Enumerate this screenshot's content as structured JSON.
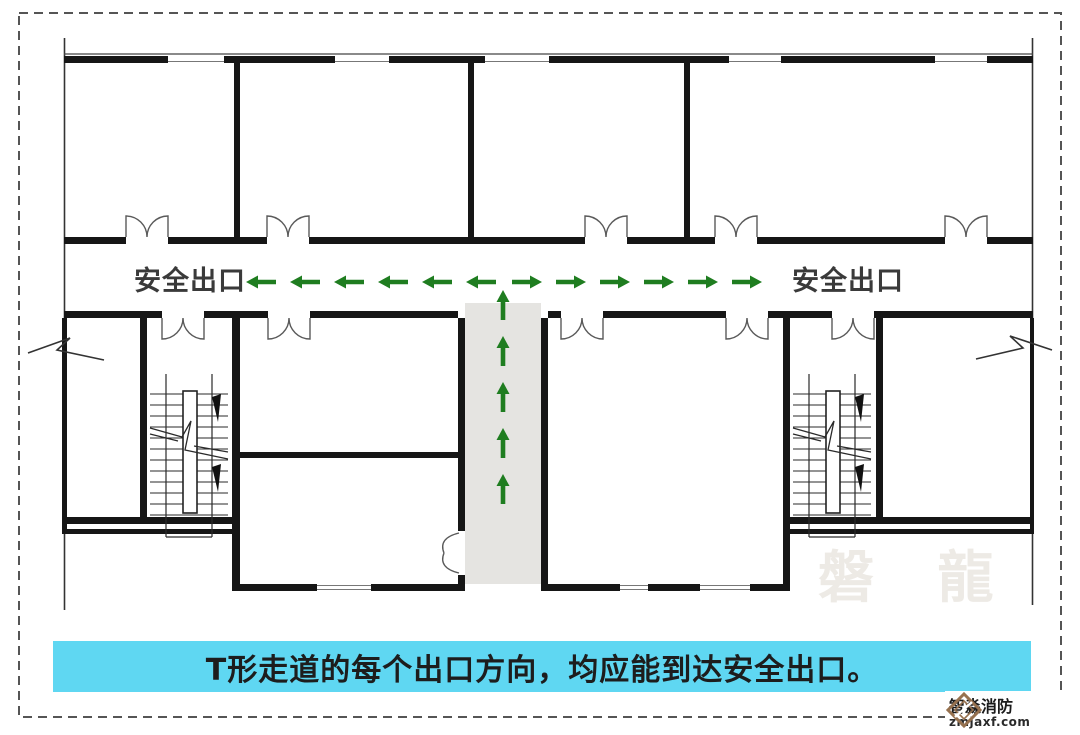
{
  "floor_plan": {
    "exit_label_left": "安全出口",
    "exit_label_right": "安全出口",
    "arrow_color": "#1f7d20",
    "corridor_fill": "#e5e4e1",
    "horizontal_arrows": {
      "pointing_left": 6,
      "pointing_right": 6
    },
    "vertical_arrows": {
      "pointing_up": 5
    }
  },
  "caption": {
    "text": "T形走道的每个出口方向，均应能到达安全出口。",
    "background_color": "#5fd7f2"
  },
  "watermark": {
    "text": "磐 龍"
  },
  "brand": {
    "name": "智淼消防",
    "domain": "zmjaxf.com",
    "icon_color": "#96714f"
  }
}
